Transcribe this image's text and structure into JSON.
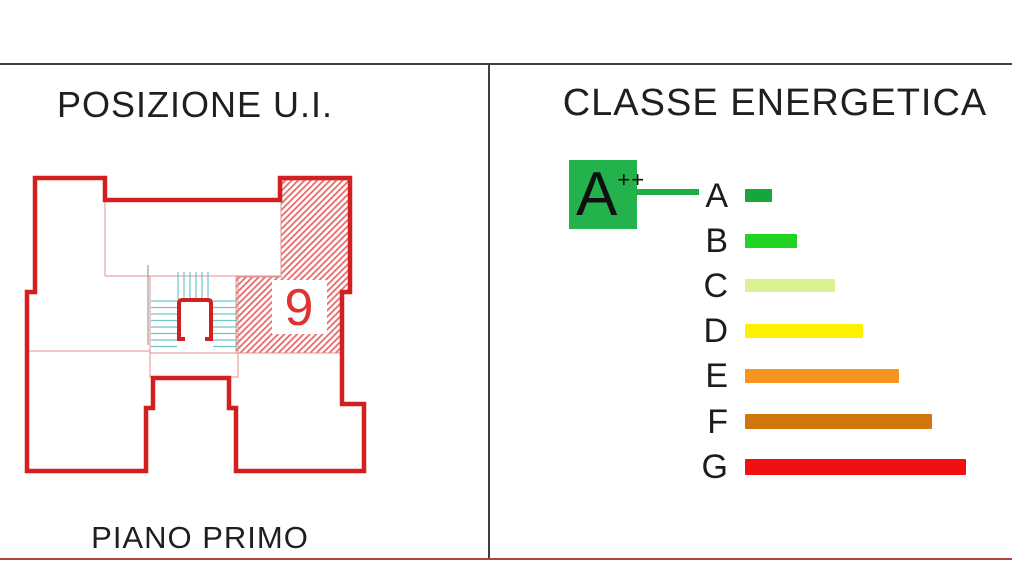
{
  "left_panel": {
    "title": "POSIZIONE U.I.",
    "unit_number": "9",
    "floor_label": "PIANO PRIMO"
  },
  "right_panel": {
    "title": "CLASSE ENERGETICA",
    "badge": {
      "label": "A",
      "superscript": "++",
      "color": "#24b24c"
    },
    "connector_color": "#1fad46",
    "classes": [
      {
        "label": "A",
        "color": "#17a63c",
        "width": 27,
        "height": 13
      },
      {
        "label": "B",
        "color": "#21d421",
        "width": 52,
        "height": 14
      },
      {
        "label": "C",
        "color": "#d9f18f",
        "width": 90,
        "height": 13
      },
      {
        "label": "D",
        "color": "#fdf000",
        "width": 118,
        "height": 14
      },
      {
        "label": "E",
        "color": "#f7941d",
        "width": 154,
        "height": 14
      },
      {
        "label": "F",
        "color": "#d1760f",
        "width": 187,
        "height": 15
      },
      {
        "label": "G",
        "color": "#ef1111",
        "width": 221,
        "height": 16
      }
    ]
  },
  "colors": {
    "plan_outline": "#d22020",
    "plan_thin_line": "#e39090",
    "hatch_stripe": "#e86a6a",
    "stair_lines": "#72c8c8",
    "divider": "#3f3f3f",
    "bottom_line": "#b24340"
  },
  "chart_data": {
    "type": "bar",
    "title": "CLASSE ENERGETICA",
    "categories": [
      "A",
      "B",
      "C",
      "D",
      "E",
      "F",
      "G"
    ],
    "values": [
      27,
      52,
      90,
      118,
      154,
      187,
      221
    ],
    "value_unit": "px-bar-length (relative energy scale, A best to G worst)",
    "annotations": [
      "A++ assigned class connected to row A"
    ],
    "legend_position": "none",
    "grid": false
  }
}
